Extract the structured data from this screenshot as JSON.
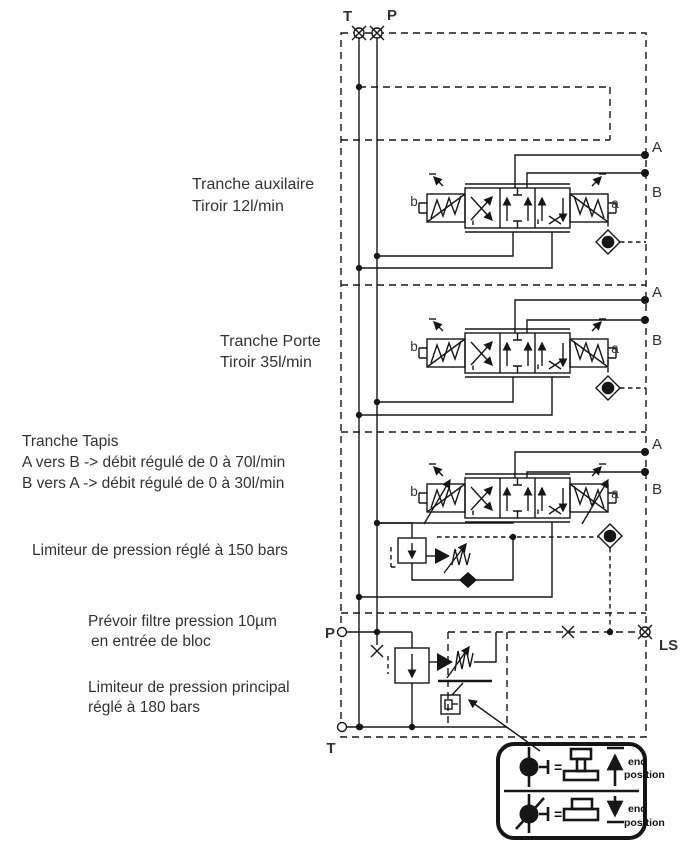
{
  "ports": {
    "top_t": "T",
    "top_p": "P",
    "bottom_p": "P",
    "bottom_t": "T",
    "ls": "LS"
  },
  "sections": [
    {
      "title": "Tranche auxilaire",
      "subtitle": "Tiroir 12l/min",
      "port_a": "A",
      "port_b": "B",
      "pilot_a": "a",
      "pilot_b": "b"
    },
    {
      "title": "Tranche Porte",
      "subtitle": "Tiroir 35l/min",
      "port_a": "A",
      "port_b": "B",
      "pilot_a": "a",
      "pilot_b": "b"
    },
    {
      "title": "Tranche Tapis",
      "note_ab": "A vers B -> débit régulé de 0 à 70l/min",
      "note_ba": "B vers A -> débit régulé de 0 à 30l/min",
      "port_a": "A",
      "port_b": "B",
      "pilot_a": "a",
      "pilot_b": "b"
    }
  ],
  "annotations": {
    "section_relief": "Limiteur de pression réglé à 150 bars",
    "filter_line1": "Prévoir filtre pression 10µm",
    "filter_line2": "en entrée de bloc",
    "main_relief_line1": "Limiteur de pression principal",
    "main_relief_line2": "réglé à 180 bars"
  },
  "legend": {
    "rows": [
      {
        "equals": "=",
        "caption_line1": "end",
        "caption_line2": "position"
      },
      {
        "equals": "=",
        "caption_line1": "end",
        "caption_line2": "position"
      }
    ]
  },
  "colors": {
    "line": "#161616",
    "text": "#333333",
    "background": "#ffffff"
  }
}
